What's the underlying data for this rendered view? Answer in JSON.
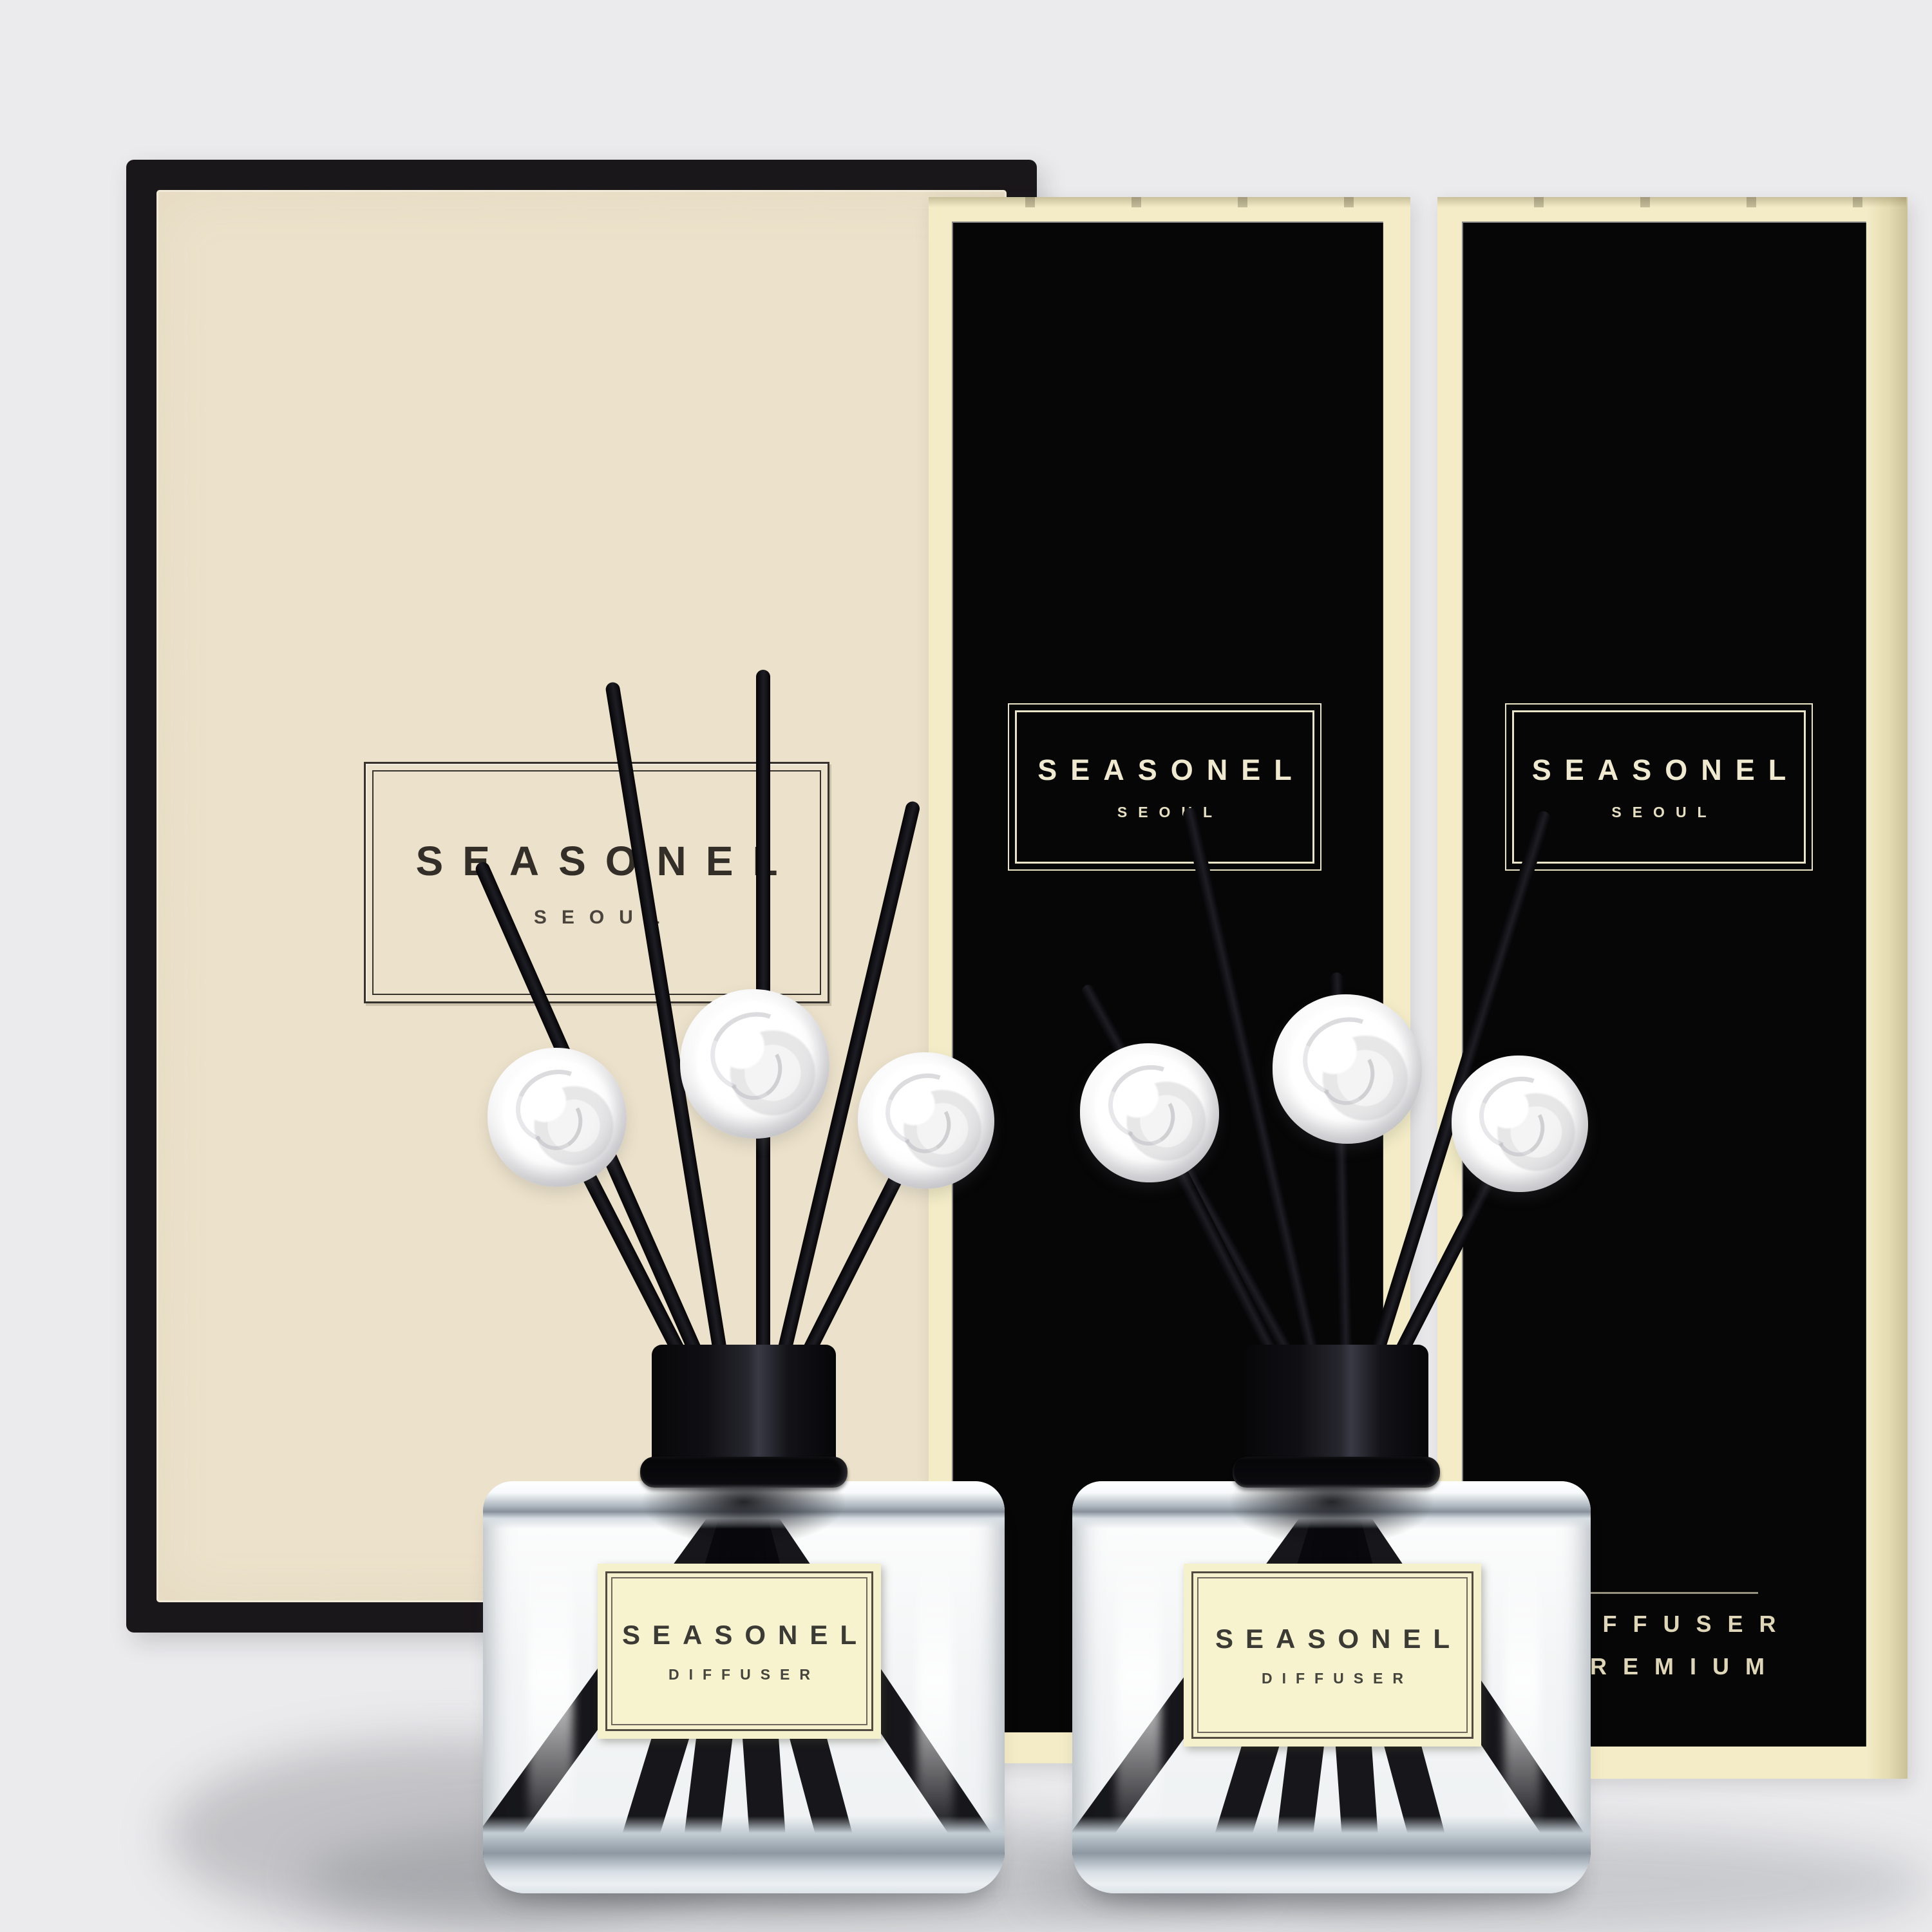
{
  "page": {
    "background_color": "#ebebed"
  },
  "gift_box": {
    "brand": "SEASONEL",
    "city": "SEOUL",
    "panel_color": "#ece2cb",
    "frame_color": "#1a171b"
  },
  "box_left": {
    "brand": "SEASONEL",
    "city": "SEOUL",
    "panel_color": "#060607",
    "trim_color": "#f3ecc6"
  },
  "box_right": {
    "brand": "SEASONEL",
    "city": "SEOUL",
    "footer_line1": "DIFFUSER",
    "footer_line2": "PREMIUM",
    "panel_color": "#060607",
    "trim_color": "#f3ecc6"
  },
  "bottle_left": {
    "brand": "SEASONEL",
    "type": "DIFFUSER",
    "reed_color": "#0a0a0e",
    "flower": "white-rose"
  },
  "bottle_right": {
    "brand": "SEASONEL",
    "type": "DIFFUSER",
    "reed_color": "#0a0a0e",
    "flower": "white-rose"
  }
}
